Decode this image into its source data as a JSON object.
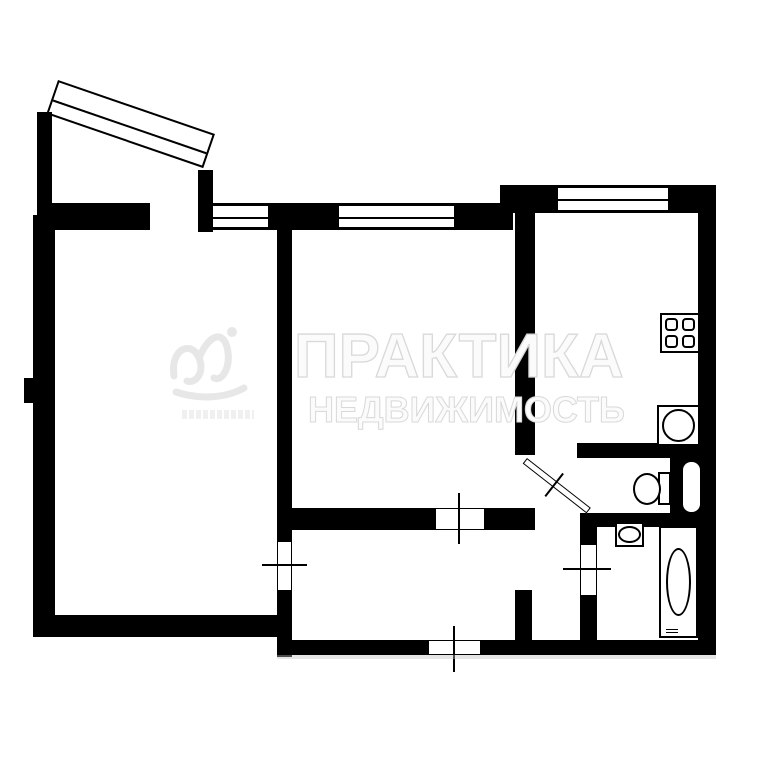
{
  "watermark": {
    "title": "ПРАКТИКА",
    "subtitle": "НЕДВИЖИМОСТЬ",
    "logo": "practika-script-logo"
  },
  "colors": {
    "wall": "#000000",
    "bg": "#ffffff",
    "wmFill": "rgba(255,255,255,0.88)",
    "wmStroke": "#d9d9d9",
    "shadow": "#bdbdbd"
  },
  "plan": {
    "windows": [
      "living-room-window",
      "bedroom-window",
      "kitchen-window"
    ],
    "doors": [
      "balcony-door",
      "living-room-door",
      "bedroom-door",
      "kitchen-door",
      "bathroom-door",
      "entry-door"
    ],
    "equipment": [
      "stove",
      "kitchen-sink",
      "toilet",
      "washbasin",
      "bathtub",
      "vent-shaft"
    ]
  }
}
